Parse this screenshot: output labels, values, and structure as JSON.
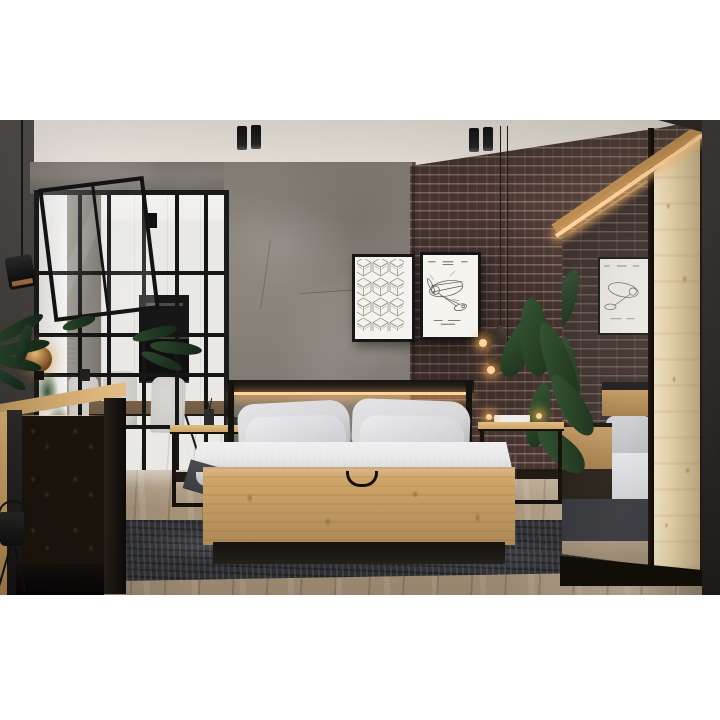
{
  "scene": {
    "type": "photograph",
    "setting": "Industrial loft bedroom with oak-and-black furniture set, concrete wall, dark red brick wall and a black-framed glass partition to a white kitchen/dining area",
    "objects": [
      "ceiling-spotlights",
      "pendant-lamp",
      "glass-partition",
      "open-glass-door",
      "kitchen-oven",
      "dining-table",
      "dining-chairs",
      "concrete-wall",
      "brick-wall",
      "geometric-cube-poster",
      "airplane-patent-poster",
      "wall-spotlights",
      "oak-dresser",
      "amber-globe-lamp",
      "black-speaker",
      "palm-plant",
      "plant-stand",
      "oak-bed",
      "headboard-led-strip",
      "pillows",
      "dark-cushions",
      "knit-throw",
      "rope-handle",
      "nightstand-left",
      "nightstand-right",
      "banana-leaf-plant",
      "mirrored-wardrobe",
      "wardrobe-led-strip",
      "charcoal-rug",
      "wood-plank-floor"
    ],
    "lighting": [
      "warm LED strips under dresser top, headboard and wardrobe edge",
      "two pairs of black cylinder ceiling spots",
      "copper wall spots glowing warm"
    ]
  },
  "colors": {
    "page_bg": "#ffffff",
    "ceiling": "#ece7df",
    "ceiling_dark": "#d8d1c5",
    "wall_left": "#45423f",
    "wall_right": "#32302d",
    "concrete": "#8e8880",
    "brick": "#4b3733",
    "brick_mortar": "#b3a296",
    "oak": "#cfa467",
    "oak_light": "#e0bc84",
    "oak_dark": "#9d7845",
    "oak_pale": "#ecd9ae",
    "black": "#171412",
    "led": "#ffd39a",
    "pillow": "#d7d7d9",
    "cushion": "#5b5d62",
    "duvet": "#e8e8e9",
    "throw": "#46484d",
    "rug": "#323338",
    "floor": "#a8947b",
    "floor_light": "#cdbda1",
    "glass": "#f3f2ef",
    "oven": "#141414",
    "plant": "#2f4c31",
    "plant_dark": "#1d311c",
    "copper": "#b97e50",
    "chair": "#cbcac6",
    "table": "#6f5a44"
  }
}
